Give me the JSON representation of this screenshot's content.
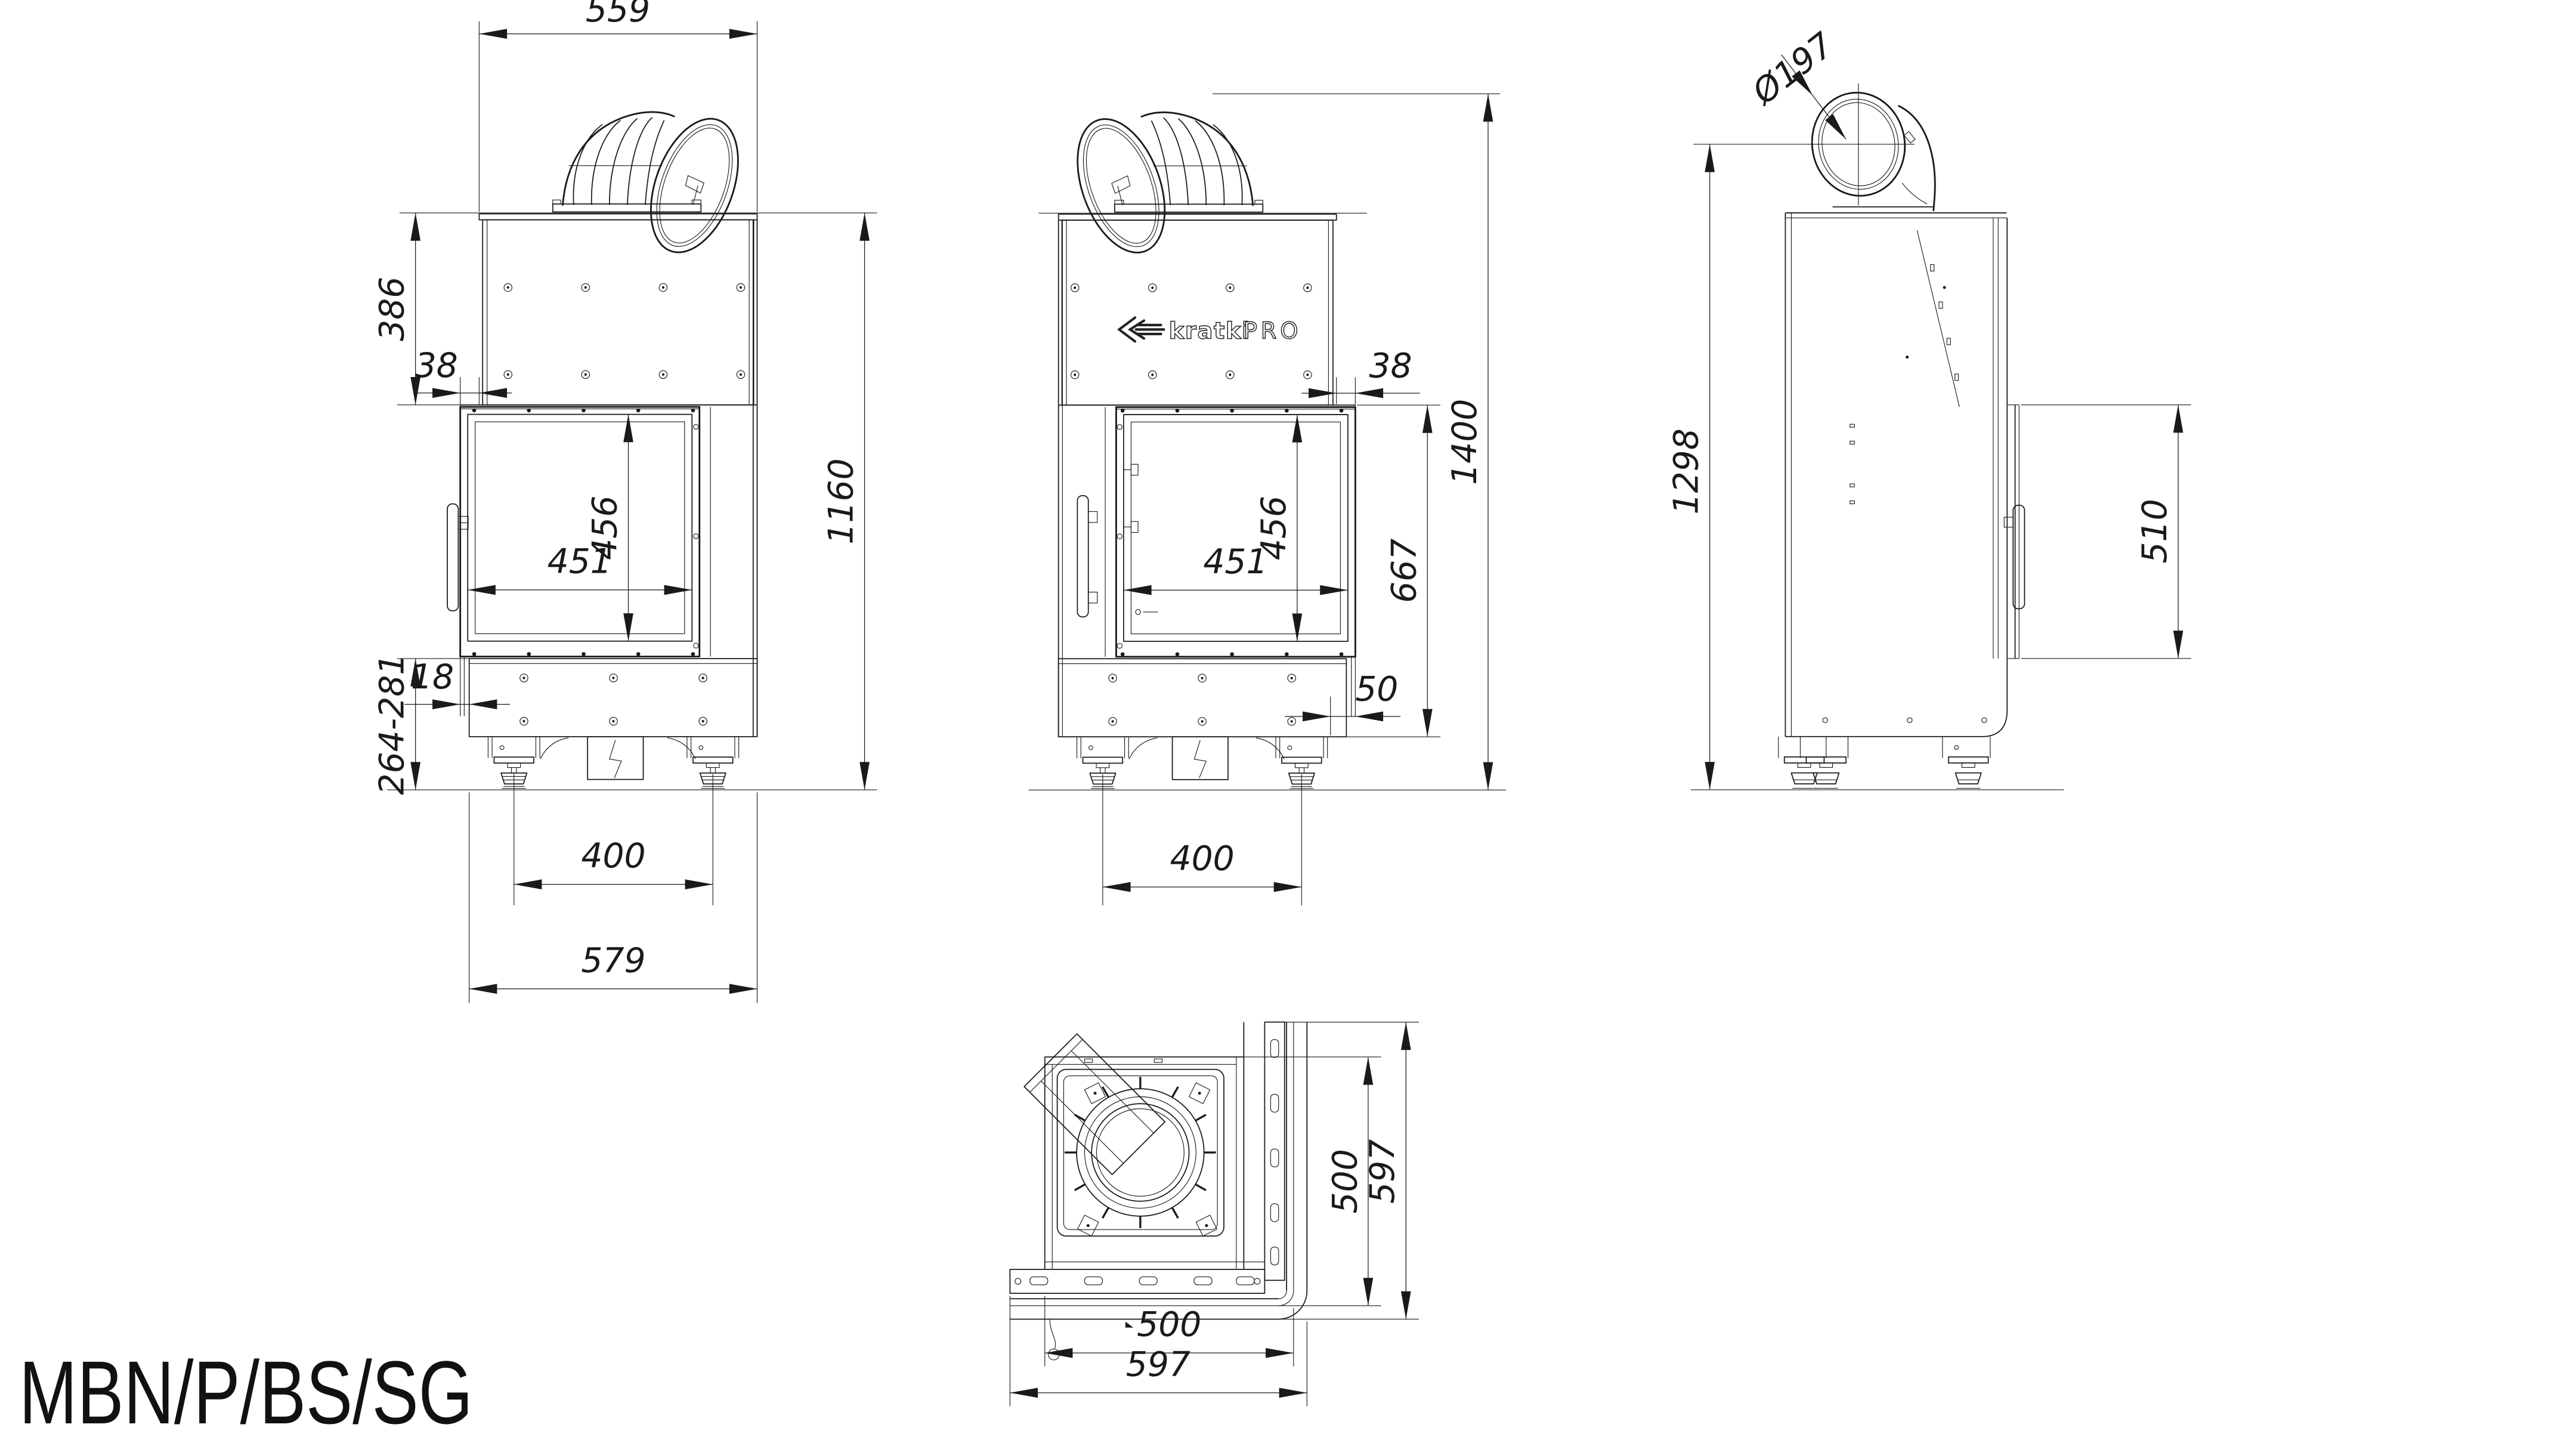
{
  "title": "MBN/P/BS/SG",
  "brand": {
    "name": "kratki",
    "series": "PRO"
  },
  "colors": {
    "line": "#1a1a1a",
    "background": "#ffffff"
  },
  "views": {
    "front_left": {
      "label": "front view, flue elbow to the right",
      "dims": {
        "top_width": "559",
        "upper_height": "386",
        "frame_offset": "38",
        "glass_width": "451",
        "glass_height": "456",
        "body_height": "1160",
        "base_step": "18",
        "base_height": "264-281",
        "feet_spacing": "400",
        "base_width": "579"
      }
    },
    "front_right": {
      "label": "front view, flue elbow to the left",
      "dims": {
        "frame_offset": "38",
        "glass_width": "451",
        "glass_height": "456",
        "firebox_height": "667",
        "total_height": "1400",
        "front_step": "50",
        "feet_spacing": "400"
      }
    },
    "side": {
      "label": "side view",
      "dims": {
        "flue_diameter": "Ø197",
        "flue_axis_height": "1298",
        "door_height": "510"
      }
    },
    "top": {
      "label": "top view",
      "dims": {
        "inner_depth": "500",
        "overall_depth": "597",
        "inner_width": "500",
        "overall_width": "597"
      }
    }
  }
}
